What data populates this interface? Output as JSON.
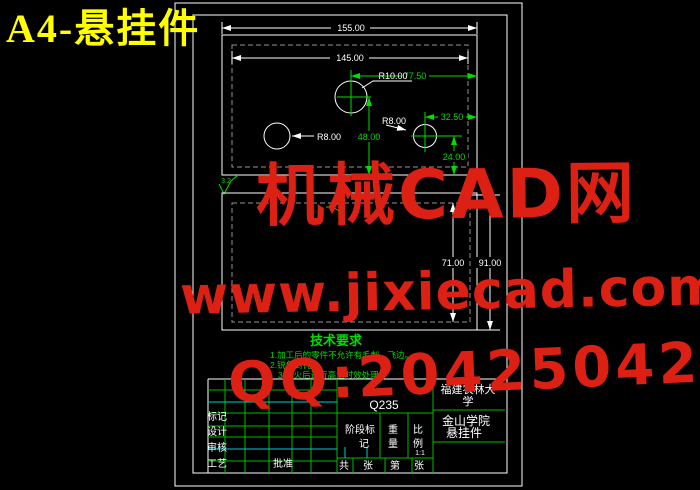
{
  "page_title": "A4-悬挂件",
  "watermark": {
    "brand": "机械CAD网",
    "url": "www.jixiecad.com",
    "qq": "QQ:20425042"
  },
  "colors": {
    "line_white": "#ffffff",
    "cad_green": "#00dd00",
    "cad_cyan": "#00cccc",
    "hidden_line_gray": "#949494",
    "watermark_red": "#dd2014",
    "title_yellow": "#ffff00"
  },
  "top_view": {
    "dim_overall_width": "155.00",
    "dim_inner_width": "145.00",
    "dim_right_offset": "77.50",
    "dim_hole_offset": "32.50",
    "dim_center_height": "48.00",
    "dim_bottom_height": "24.00",
    "label_r10": "R10.00",
    "label_r8_left": "R8.00",
    "label_r8_right": "R8.00",
    "roughness_value": "3.2"
  },
  "front_view": {
    "dim_inner_height": "71.00",
    "dim_outer_height": "91.00"
  },
  "tech_requirements": {
    "title": "技术要求",
    "items": [
      "1.加工后的零件不允许有毛刺、飞边。",
      "2.锐角倒钝。",
      "3.淬火后进行高温时效处理。"
    ]
  },
  "title_block": {
    "material": "Q235",
    "stage_label": [
      "阶段标",
      "记"
    ],
    "weight_label": [
      "重",
      "量"
    ],
    "scale_label": [
      "比",
      "例"
    ],
    "scale_value": "1:1",
    "sheet_row": [
      "共",
      "张",
      "第",
      "张"
    ],
    "approve_label": "批准",
    "row_labels": [
      "标记",
      "设计",
      "审核",
      "工艺"
    ],
    "org_line1": "福建农林大",
    "org_line2": "学",
    "org_line3": "金山学院",
    "part_name": "悬挂件"
  }
}
